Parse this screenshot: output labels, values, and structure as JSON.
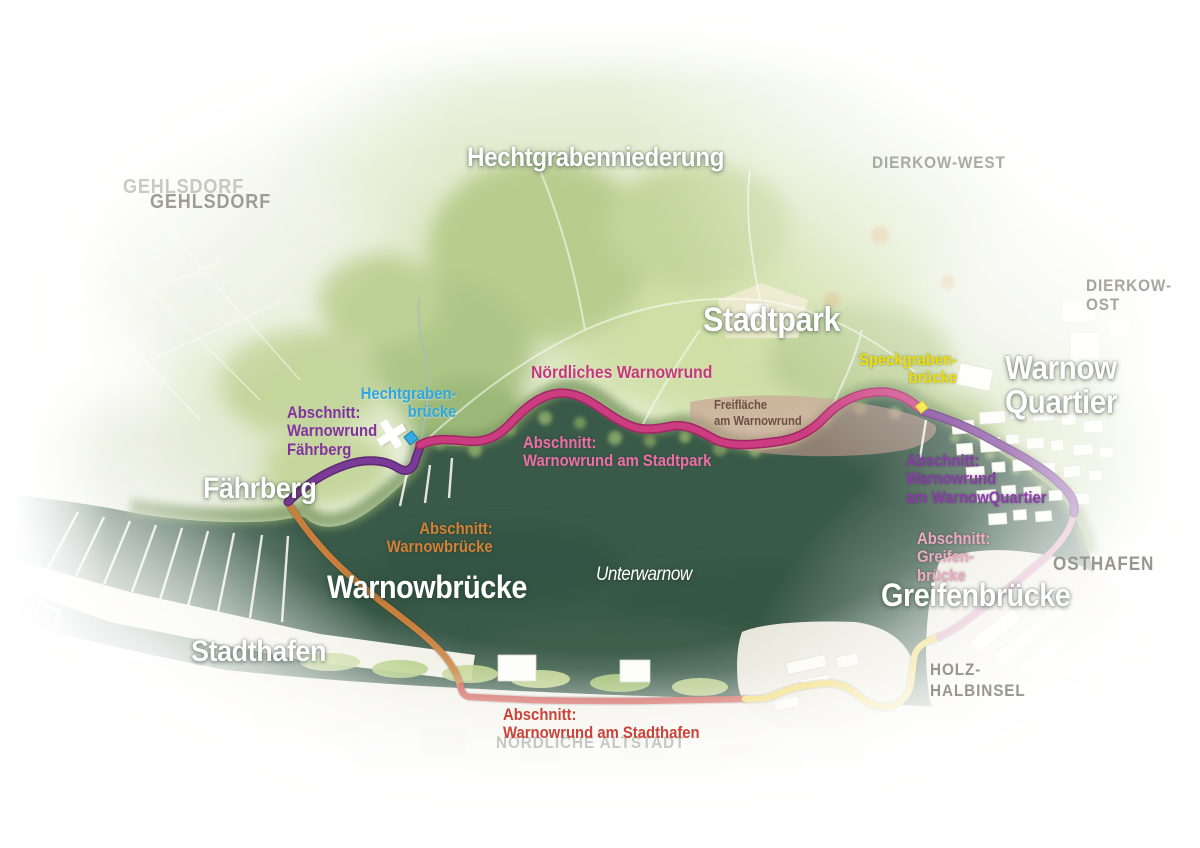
{
  "map": {
    "places": {
      "hechtgrabenniederung": "Hechtgrabenniederung",
      "gehlsdorf": "GEHLSDORF",
      "dierkow_west": "DIERKOW-WEST",
      "dierkow_ost": "DIERKOW-OST",
      "stadtpark": "Stadtpark",
      "warnow_quartier": "Warnow\nQuartier",
      "faehrberg": "Fährberg",
      "unterwarnow": "Unterwarnow",
      "warnowbruecke": "Warnowbrücke",
      "greifenbruecke": "Greifenbrücke",
      "stadthafen": "Stadthafen",
      "osthafen": "OSTHAFEN",
      "holz_halbinsel": "HOLZ-\nHALBINSEL",
      "noerdliche_altstadt": "NÖRDLICHE ALTSTADT",
      "freiflaeche_am_warnowrund": "Freifläche\nam Warnowrund",
      "noerdliches_warnowrund": "Nördliches Warnowrund"
    },
    "bridges": {
      "hechtgrabenbruecke": "Hechtgraben-\nbrücke",
      "speckgrabenbruecke": "Speckgraben-\nbrücke"
    },
    "sections": {
      "faehrberg": "Abschnitt:\nWarnowrund\nFährberg",
      "stadtpark": "Abschnitt:\nWarnowrund am Stadtpark",
      "warnow_quartier": "Abschnitt:\nWarnowrund\nam WarnowQuartier",
      "greifenbruecke": "Abschnitt:\nGreifen-\nbrücke",
      "warnowbruecke": "Abschnitt:\nWarnowbrücke",
      "stadthafen": "Abschnitt:\nWarnowrund am Stadthafen"
    },
    "colors": {
      "route_purple": "#7a3a97",
      "route_purple_dark": "#5c2a73",
      "route_pink": "#cb3c80",
      "route_pink_dark": "#a12663",
      "route_rose": "#d795b6",
      "route_yellow": "#ecd14b",
      "route_orange": "#c97f3c",
      "route_red": "#c8443a",
      "marker_cyan": "#36a9e0",
      "marker_yellow": "#f6e41c",
      "water_deep": "#3a5a49",
      "water_light": "#476750",
      "label_purple": "#8333a0",
      "label_pink": "#c6387c",
      "label_pink_light": "#ed6fa6",
      "label_rose": "#efa9c5",
      "label_yellow": "#f0dd05",
      "label_cyan": "#2fa7de",
      "label_orange": "#d28136",
      "label_red": "#cb4238"
    }
  }
}
